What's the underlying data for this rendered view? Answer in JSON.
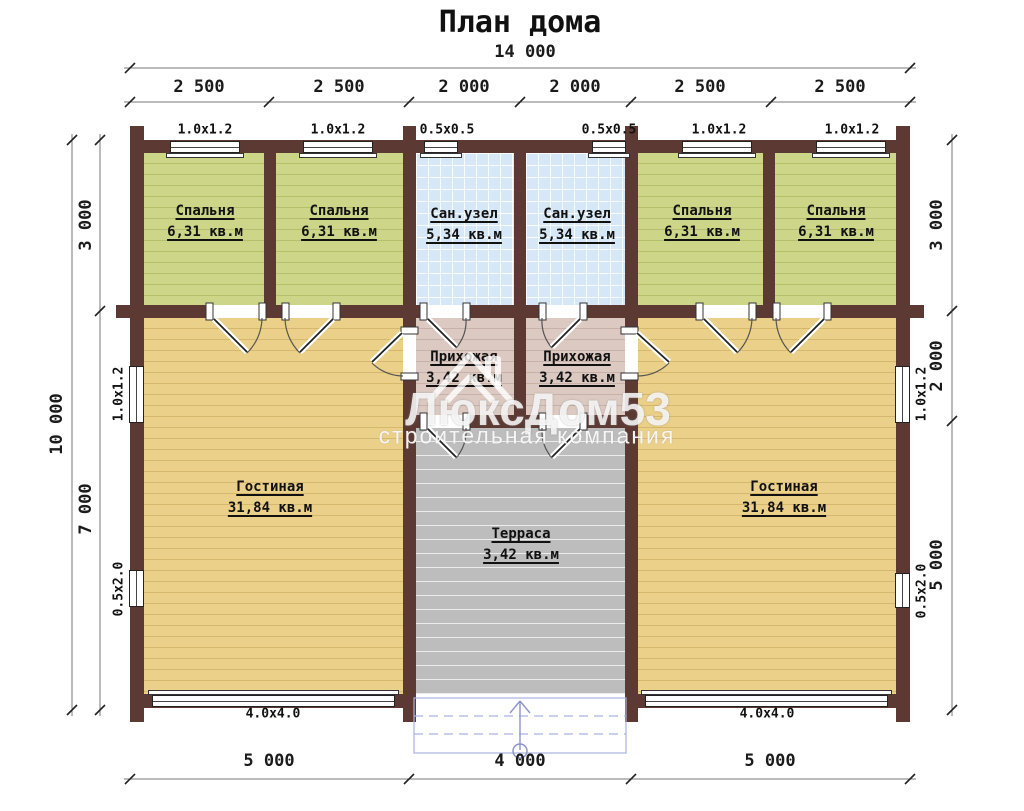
{
  "title": "План дома",
  "watermark": {
    "brand": "ЛюксДом53",
    "tagline": "строительная компания"
  },
  "dimensions": {
    "top_total": "14 000",
    "top_segments": [
      "2 500",
      "2 500",
      "2 000",
      "2 000",
      "2 500",
      "2 500"
    ],
    "left_total": "10 000",
    "left_segments": [
      "3 000",
      "7 000"
    ],
    "right_segments": [
      "3 000",
      "2 000",
      "5 000"
    ],
    "bottom_segments": [
      "5 000",
      "4 000",
      "5 000"
    ]
  },
  "rooms": [
    {
      "name": "Спальня",
      "area": "6,31 кв.м"
    },
    {
      "name": "Спальня",
      "area": "6,31 кв.м"
    },
    {
      "name": "Сан.узел",
      "area": "5,34 кв.м"
    },
    {
      "name": "Сан.узел",
      "area": "5,34 кв.м"
    },
    {
      "name": "Спальня",
      "area": "6,31 кв.м"
    },
    {
      "name": "Спальня",
      "area": "6,31 кв.м"
    },
    {
      "name": "Прихожая",
      "area": "3,42 кв.м"
    },
    {
      "name": "Прихожая",
      "area": "3,42 кв.м"
    },
    {
      "name": "Гостиная",
      "area": "31,84 кв.м"
    },
    {
      "name": "Гостиная",
      "area": "31,84 кв.м"
    },
    {
      "name": "Терраса",
      "area": "3,42 кв.м"
    }
  ],
  "windows": {
    "top": [
      "1.0x1.2",
      "1.0x1.2",
      "0.5x0.5",
      "0.5x0.5",
      "1.0x1.2",
      "1.0x1.2"
    ],
    "left": [
      "1.0x1.2",
      "0.5x2.0"
    ],
    "right": [
      "1.0x1.2",
      "0.5x2.0"
    ],
    "bottom": [
      "4.0x4.0",
      "4.0x4.0"
    ]
  },
  "colors": {
    "wall": "#5c3a33",
    "bedroom_fill": "#cdd688",
    "bathroom_fill": "#d6e7f7",
    "hall_fill": "#dccac2",
    "living_fill": "#ebd089",
    "terrace_fill": "#bdbdbd",
    "steps_blue": "#a9b2e0"
  }
}
